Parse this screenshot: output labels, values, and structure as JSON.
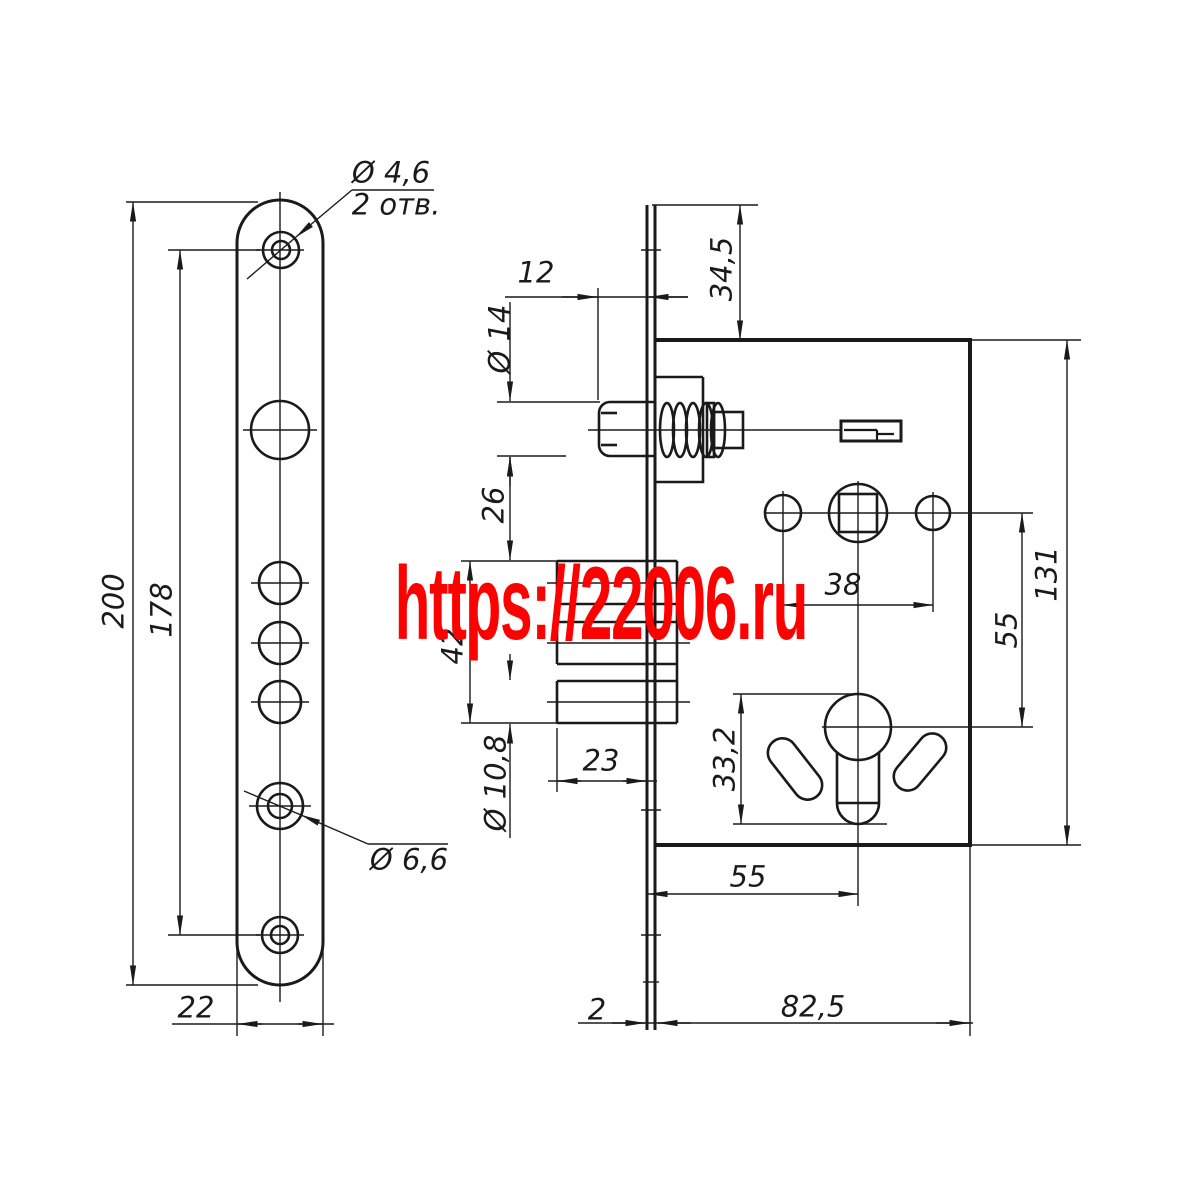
{
  "colors": {
    "line": "#1a1a1a",
    "watermark": "#ff0000"
  },
  "watermark": {
    "text": "https://22006.ru"
  },
  "faceplate_view": {
    "hole_top_dia": "Ø 4,6",
    "hole_top_count": "2 отв.",
    "total_height": "200",
    "hole_span_height": "178",
    "plate_width": "22",
    "hole_bottom_dia": "Ø 6,6"
  },
  "body_view": {
    "latch_protrusion": "12",
    "latch_top_offset": "34,5",
    "latch_dia": "Ø 14",
    "latch_to_deadbolt": "26",
    "deadbolt_height": "42",
    "deadbolt_pin_dia": "Ø 10,8",
    "deadbolt_throw": "23",
    "fixing_holes_span": "38",
    "body_height": "131",
    "spindle_to_cylinder": "55",
    "cylinder_hole_height": "33,2",
    "backset": "55",
    "faceplate_thickness": "2",
    "body_depth": "82,5"
  }
}
